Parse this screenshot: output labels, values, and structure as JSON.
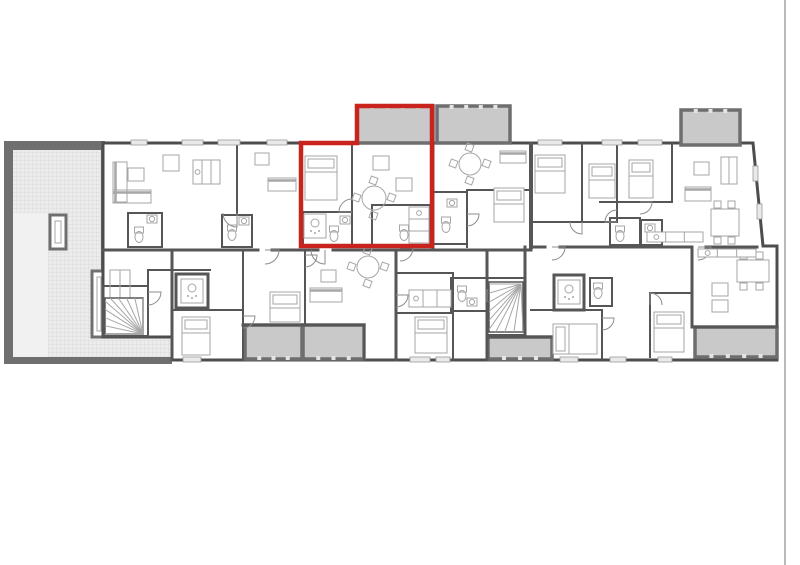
{
  "canvas": {
    "width": 800,
    "height": 565,
    "background": "#ffffff"
  },
  "colors": {
    "wall": "#565656",
    "outline": "#4d4d4d",
    "furniture": "#a6a6a6",
    "balcony_fill": "#c9c9c9",
    "balcony_stroke": "#6e6e6e",
    "balcony_post": "#e4e4e4",
    "terrace_wall": "#6f6f6f",
    "hatch_bg": "#ececec",
    "hatch_line": "#d7d7d7",
    "plain_fill": "#f1f1f1",
    "window_fill": "#e9e9e9",
    "window_stroke": "#9a9a9a",
    "door": "#8c8c8c",
    "edge_line": "#b3b3b3",
    "highlight": "#c8231d",
    "room_fill": "#ffffff"
  },
  "page_edge": {
    "x": 785,
    "y1": 0,
    "y2": 565,
    "width": 1.8
  },
  "building": {
    "points": "103,143 753,143 763,246 777,246 777,360 172,360 172,337 103,337",
    "stroke_width": 3
  },
  "terrace": {
    "outer": {
      "x": 4,
      "y": 141,
      "w": 101,
      "h": 223
    },
    "inner": {
      "x": 13,
      "y": 150,
      "w": 88,
      "h": 207
    },
    "plain": {
      "x": 13,
      "y": 213,
      "w": 35,
      "h": 144
    },
    "ext_hatch": {
      "x": 101,
      "y": 337,
      "w": 71,
      "h": 20
    },
    "ext_band": {
      "x": 101,
      "y": 357,
      "w": 71,
      "h": 7
    },
    "windows": [
      [
        50,
        215,
        16,
        34
      ],
      [
        92,
        271,
        14,
        66
      ]
    ]
  },
  "balconies": [
    {
      "x": 357,
      "y": 106,
      "w": 76,
      "h": 37,
      "edge": "top"
    },
    {
      "x": 437,
      "y": 106,
      "w": 73,
      "h": 37,
      "edge": "top"
    },
    {
      "x": 681,
      "y": 110,
      "w": 59,
      "h": 35,
      "edge": "top"
    },
    {
      "x": 245,
      "y": 325,
      "w": 57,
      "h": 34,
      "edge": "bottom"
    },
    {
      "x": 303,
      "y": 325,
      "w": 61,
      "h": 34,
      "edge": "bottom"
    },
    {
      "x": 488,
      "y": 337,
      "w": 64,
      "h": 22,
      "edge": "bottom"
    },
    {
      "x": 695,
      "y": 327,
      "w": 82,
      "h": 30,
      "edge": "bottom"
    }
  ],
  "highlight": {
    "points": "301,143 357,143 357,106 432,106 432,246 301,246",
    "width": 4.5
  },
  "walls": [
    [
      237,
      144,
      237,
      213,
      2
    ],
    [
      301,
      144,
      301,
      246,
      3
    ],
    [
      352,
      144,
      352,
      212,
      2
    ],
    [
      433,
      144,
      433,
      248,
      3
    ],
    [
      531,
      144,
      531,
      247,
      4
    ],
    [
      582,
      144,
      582,
      222,
      2
    ],
    [
      617,
      144,
      617,
      222,
      2
    ],
    [
      672,
      144,
      672,
      202,
      2
    ],
    [
      531,
      222,
      617,
      222,
      2
    ],
    [
      600,
      202,
      672,
      202,
      2
    ],
    [
      467,
      190,
      467,
      247,
      2
    ],
    [
      467,
      190,
      531,
      190,
      2
    ],
    [
      103,
      250,
      258,
      250,
      3
    ],
    [
      272,
      250,
      318,
      250,
      3
    ],
    [
      333,
      250,
      433,
      250,
      3
    ],
    [
      433,
      250,
      531,
      250,
      3
    ],
    [
      531,
      247,
      545,
      247,
      3
    ],
    [
      560,
      247,
      692,
      247,
      3
    ],
    [
      706,
      247,
      757,
      247,
      3
    ],
    [
      172,
      250,
      172,
      360,
      3
    ],
    [
      243,
      250,
      243,
      360,
      2
    ],
    [
      305,
      250,
      305,
      325,
      2
    ],
    [
      364,
      325,
      364,
      360,
      2
    ],
    [
      396,
      250,
      396,
      360,
      3
    ],
    [
      453,
      273,
      453,
      360,
      2
    ],
    [
      487,
      250,
      487,
      360,
      3
    ],
    [
      525,
      247,
      525,
      337,
      3
    ],
    [
      602,
      310,
      602,
      358,
      2
    ],
    [
      650,
      293,
      650,
      357,
      2
    ],
    [
      692,
      247,
      692,
      327,
      3
    ],
    [
      243,
      325,
      364,
      325,
      3
    ],
    [
      396,
      273,
      453,
      273,
      2
    ],
    [
      396,
      313,
      453,
      313,
      2
    ],
    [
      172,
      310,
      243,
      310,
      2
    ],
    [
      487,
      337,
      552,
      337,
      3
    ],
    [
      531,
      310,
      602,
      310,
      2
    ],
    [
      650,
      293,
      692,
      293,
      2
    ],
    [
      692,
      327,
      777,
      327,
      3
    ],
    [
      148,
      270,
      148,
      336,
      2
    ],
    [
      148,
      270,
      210,
      270,
      2
    ]
  ],
  "boxes": [
    [
      128,
      213,
      34,
      34,
      2
    ],
    [
      222,
      215,
      30,
      32,
      2
    ],
    [
      303,
      212,
      49,
      34,
      2
    ],
    [
      372,
      205,
      58,
      41,
      2
    ],
    [
      433,
      192,
      34,
      52,
      2
    ],
    [
      610,
      218,
      30,
      27,
      2
    ],
    [
      641,
      220,
      21,
      25,
      2
    ],
    [
      176,
      274,
      32,
      34,
      3
    ],
    [
      554,
      275,
      30,
      35,
      3
    ],
    [
      451,
      278,
      36,
      33,
      2
    ],
    [
      590,
      278,
      22,
      28,
      2
    ],
    [
      103,
      286,
      45,
      50,
      2
    ],
    [
      487,
      278,
      38,
      57,
      2
    ]
  ],
  "windows": [
    [
      131,
      140,
      16,
      5
    ],
    [
      182,
      140,
      21,
      5
    ],
    [
      218,
      140,
      22,
      5
    ],
    [
      267,
      140,
      20,
      5
    ],
    [
      538,
      140,
      24,
      5
    ],
    [
      602,
      140,
      20,
      5
    ],
    [
      638,
      140,
      24,
      5
    ],
    [
      753,
      166,
      5,
      15
    ],
    [
      757,
      204,
      5,
      15
    ],
    [
      183,
      357,
      18,
      5
    ],
    [
      410,
      357,
      20,
      5
    ],
    [
      436,
      357,
      14,
      5
    ],
    [
      560,
      357,
      18,
      5
    ],
    [
      610,
      357,
      16,
      5
    ],
    [
      658,
      357,
      14,
      5
    ]
  ],
  "doors": [
    [
      237,
      213,
      14,
      1
    ],
    [
      352,
      212,
      13,
      2
    ],
    [
      400,
      248,
      13,
      0
    ],
    [
      467,
      214,
      12,
      0
    ],
    [
      582,
      222,
      12,
      1
    ],
    [
      617,
      222,
      12,
      2
    ],
    [
      640,
      202,
      12,
      0
    ],
    [
      148,
      292,
      13,
      0
    ],
    [
      265,
      250,
      14,
      0
    ],
    [
      325,
      250,
      14,
      1
    ],
    [
      552,
      247,
      13,
      0
    ],
    [
      698,
      247,
      13,
      0
    ],
    [
      396,
      295,
      12,
      0
    ],
    [
      487,
      302,
      12,
      3
    ],
    [
      602,
      318,
      12,
      0
    ],
    [
      650,
      305,
      12,
      3
    ],
    [
      243,
      316,
      12,
      0
    ],
    [
      305,
      255,
      12,
      0
    ]
  ],
  "furniture": [
    {
      "t": "bed",
      "x": 305,
      "y": 156,
      "w": 32,
      "h": 44
    },
    {
      "t": "bed",
      "x": 494,
      "y": 188,
      "w": 30,
      "h": 34
    },
    {
      "t": "bed",
      "x": 535,
      "y": 155,
      "w": 30,
      "h": 38
    },
    {
      "t": "bed",
      "x": 589,
      "y": 164,
      "w": 26,
      "h": 34
    },
    {
      "t": "bed",
      "x": 629,
      "y": 160,
      "w": 24,
      "h": 38
    },
    {
      "t": "bed",
      "x": 182,
      "y": 317,
      "w": 28,
      "h": 38
    },
    {
      "t": "bed",
      "x": 270,
      "y": 292,
      "w": 30,
      "h": 30
    },
    {
      "t": "bed",
      "x": 415,
      "y": 317,
      "w": 32,
      "h": 36
    },
    {
      "t": "bedh",
      "x": 553,
      "y": 324,
      "w": 44,
      "h": 30
    },
    {
      "t": "bed",
      "x": 654,
      "y": 312,
      "w": 30,
      "h": 40
    },
    {
      "t": "rtable",
      "cx": 374,
      "cy": 198,
      "r": 12
    },
    {
      "t": "rtable",
      "cx": 470,
      "cy": 164,
      "r": 11
    },
    {
      "t": "rtable",
      "cx": 368,
      "cy": 267,
      "r": 11
    },
    {
      "t": "stable",
      "x": 128,
      "y": 168,
      "w": 16,
      "h": 13
    },
    {
      "t": "stable",
      "x": 163,
      "y": 155,
      "w": 16,
      "h": 16
    },
    {
      "t": "stable",
      "x": 255,
      "y": 153,
      "w": 14,
      "h": 12
    },
    {
      "t": "stable",
      "x": 373,
      "y": 156,
      "w": 16,
      "h": 14
    },
    {
      "t": "stable",
      "x": 396,
      "y": 178,
      "w": 16,
      "h": 13
    },
    {
      "t": "stable",
      "x": 694,
      "y": 162,
      "w": 15,
      "h": 13
    },
    {
      "t": "stable",
      "x": 712,
      "y": 283,
      "w": 16,
      "h": 13
    },
    {
      "t": "stable",
      "x": 712,
      "y": 300,
      "w": 16,
      "h": 12
    },
    {
      "t": "stable",
      "x": 321,
      "y": 270,
      "w": 15,
      "h": 12
    },
    {
      "t": "dining",
      "x": 711,
      "y": 209,
      "w": 28,
      "h": 27
    },
    {
      "t": "dining",
      "x": 737,
      "y": 260,
      "w": 32,
      "h": 22
    },
    {
      "t": "sofa",
      "x": 113,
      "y": 162,
      "w": 14,
      "h": 40
    },
    {
      "t": "sofa",
      "x": 113,
      "y": 190,
      "w": 38,
      "h": 13
    },
    {
      "t": "sofa",
      "x": 268,
      "y": 178,
      "w": 28,
      "h": 13
    },
    {
      "t": "sofa",
      "x": 500,
      "y": 151,
      "w": 26,
      "h": 12
    },
    {
      "t": "sofa",
      "x": 685,
      "y": 187,
      "w": 26,
      "h": 14
    },
    {
      "t": "sofa",
      "x": 310,
      "y": 288,
      "w": 32,
      "h": 14
    },
    {
      "t": "kitchen",
      "x": 193,
      "y": 160,
      "w": 27,
      "h": 24
    },
    {
      "t": "kitchen",
      "x": 409,
      "y": 207,
      "w": 20,
      "h": 36
    },
    {
      "t": "kitchen",
      "x": 647,
      "y": 232,
      "w": 56,
      "h": 10
    },
    {
      "t": "kitchen",
      "x": 409,
      "y": 290,
      "w": 42,
      "h": 17
    },
    {
      "t": "kitchen",
      "x": 698,
      "y": 249,
      "w": 58,
      "h": 8
    },
    {
      "t": "wardrobe",
      "x": 110,
      "y": 270,
      "w": 20,
      "h": 37
    },
    {
      "t": "wardrobe",
      "x": 721,
      "y": 157,
      "w": 16,
      "h": 27
    },
    {
      "t": "wc",
      "cx": 139,
      "cy": 232
    },
    {
      "t": "wc",
      "cx": 232,
      "cy": 230
    },
    {
      "t": "wc",
      "cx": 334,
      "cy": 231
    },
    {
      "t": "wc",
      "cx": 404,
      "cy": 230
    },
    {
      "t": "wc",
      "cx": 446,
      "cy": 222
    },
    {
      "t": "wc",
      "cx": 620,
      "cy": 231
    },
    {
      "t": "wc",
      "cx": 462,
      "cy": 291
    },
    {
      "t": "wc",
      "cx": 598,
      "cy": 288
    },
    {
      "t": "sink",
      "cx": 152,
      "cy": 219
    },
    {
      "t": "sink",
      "cx": 244,
      "cy": 221
    },
    {
      "t": "sink",
      "cx": 345,
      "cy": 220
    },
    {
      "t": "sink",
      "cx": 452,
      "cy": 203
    },
    {
      "t": "sink",
      "cx": 650,
      "cy": 228
    },
    {
      "t": "sink",
      "cx": 472,
      "cy": 302
    },
    {
      "t": "shower",
      "cx": 192,
      "cy": 291
    },
    {
      "t": "shower",
      "cx": 569,
      "cy": 292
    },
    {
      "t": "shower",
      "cx": 315,
      "cy": 226
    }
  ],
  "stairs": [
    {
      "rect": [
        105,
        298,
        38,
        36
      ],
      "o": [
        143,
        334
      ],
      "pts": [
        [
          105,
          334
        ],
        [
          105,
          298
        ],
        [
          143,
          298
        ]
      ]
    },
    {
      "rect": [
        489,
        282,
        34,
        50
      ],
      "o": [
        521,
        284
      ],
      "pts": [
        [
          489,
          284
        ],
        [
          489,
          332
        ],
        [
          523,
          332
        ]
      ]
    }
  ]
}
